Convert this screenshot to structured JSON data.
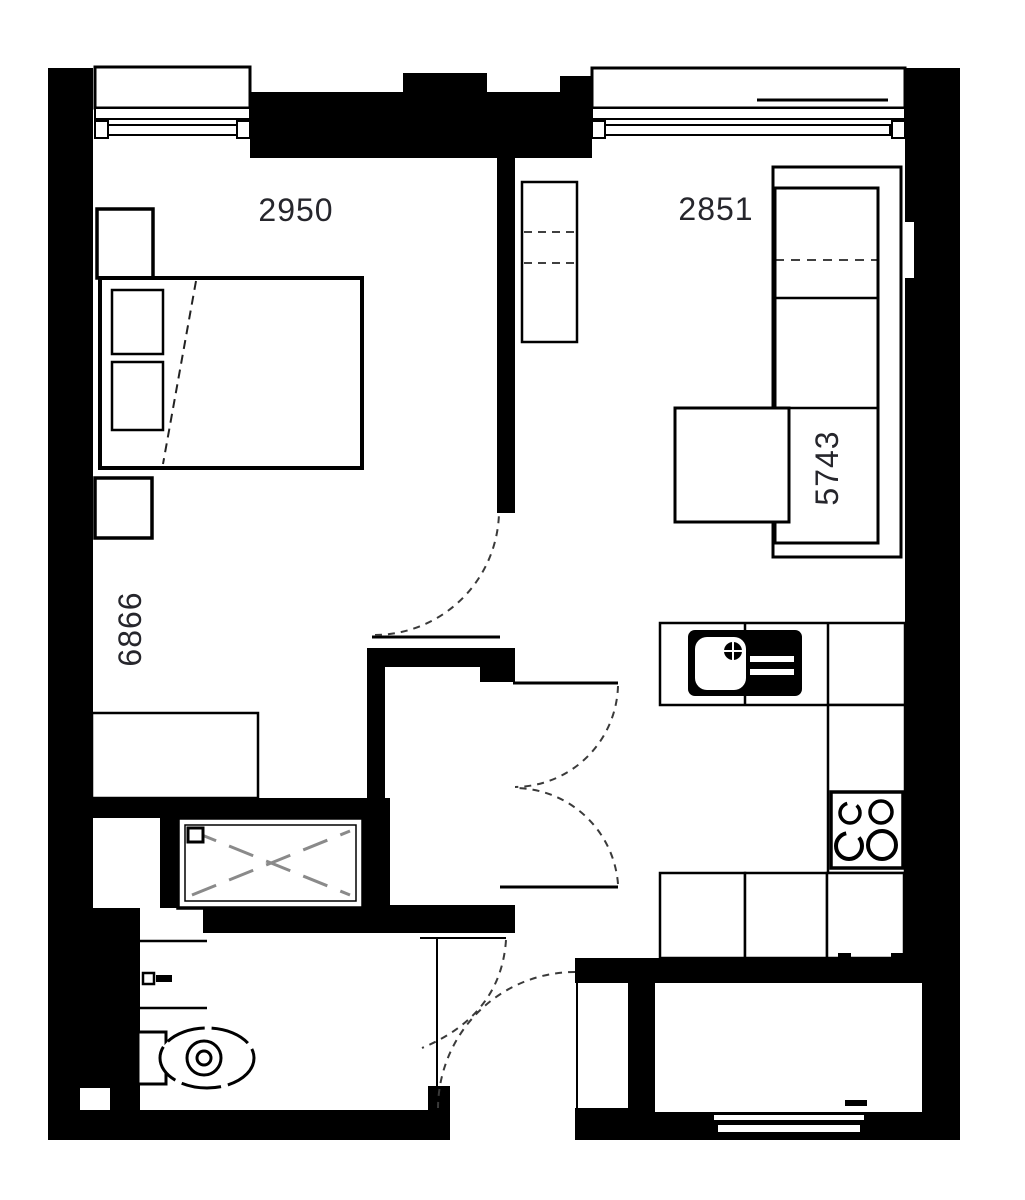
{
  "floorplan": {
    "dimensions": {
      "bedroom_width_mm": "2950",
      "living_width_mm": "2851",
      "living_length_mm": "5743",
      "bedroom_length_mm": "6866"
    },
    "colors": {
      "wall": "#000000",
      "background": "#ffffff",
      "furniture_line": "#0a0a0a",
      "dimension_text": "#26262c",
      "door_arc": "#3a3a3a",
      "shower_cross": "#8a8a8a"
    }
  }
}
